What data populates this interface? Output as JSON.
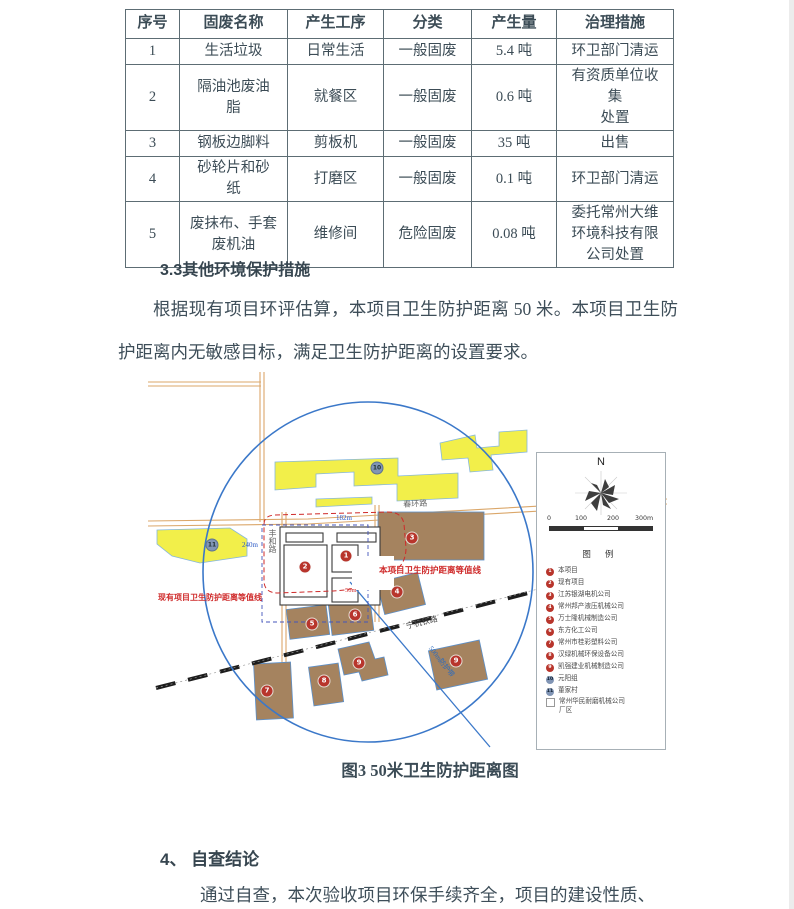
{
  "document": {
    "table": {
      "headers": [
        "序号",
        "固废名称",
        "产生工序",
        "分类",
        "产生量",
        "治理措施"
      ],
      "rows": [
        [
          "1",
          "生活垃圾",
          "日常生活",
          "一般固废",
          "5.4 吨",
          "环卫部门清运"
        ],
        [
          "2",
          "隔油池废油\n脂",
          "就餐区",
          "一般固废",
          "0.6 吨",
          "有资质单位收\n集\n处置"
        ],
        [
          "3",
          "钢板边脚料",
          "剪板机",
          "一般固废",
          "35 吨",
          "出售"
        ],
        [
          "4",
          "砂轮片和砂\n纸",
          "打磨区",
          "一般固废",
          "0.1 吨",
          "环卫部门清运"
        ],
        [
          "5",
          "废抹布、手套\n废机油",
          "维修间",
          "危险固废",
          "0.08 吨",
          "委托常州大维\n环境科技有限\n公司处置"
        ]
      ]
    },
    "section33": {
      "heading": "3.3其他环境保护措施",
      "paragraph": "根据现有项目环评估算，本项目卫生防护距离 50 米。本项目卫生防护距离内无敏感目标，满足卫生防护距离的设置要求。"
    },
    "figure": {
      "caption": "图3  50米卫生防护距离图",
      "map": {
        "north_label": "N",
        "scale_ticks": [
          "0",
          "100",
          "200",
          "300m"
        ],
        "legend_title": "图 例",
        "legend_items": [
          {
            "num": "1",
            "type": "red",
            "label": "本项目"
          },
          {
            "num": "2",
            "type": "red",
            "label": "现有项目"
          },
          {
            "num": "3",
            "type": "red",
            "label": "江苏银湖电机公司"
          },
          {
            "num": "4",
            "type": "red",
            "label": "常州邦产液压机械公司"
          },
          {
            "num": "5",
            "type": "red",
            "label": "万士隆机械制造公司"
          },
          {
            "num": "6",
            "type": "red",
            "label": "东方化工公司"
          },
          {
            "num": "7",
            "type": "red",
            "label": "常州市桂彩塑料公司"
          },
          {
            "num": "8",
            "type": "red",
            "label": "汉绿机械环保设备公司"
          },
          {
            "num": "9",
            "type": "red",
            "label": "凯强建业机械制造公司"
          },
          {
            "num": "10",
            "type": "blue",
            "label": "元阳组"
          },
          {
            "num": "11",
            "type": "blue",
            "label": "董家村"
          },
          {
            "num": "",
            "type": "square",
            "label": "常州华民耐磨机械公司\n厂区"
          }
        ],
        "road_labels": {
          "east_west": "春环路",
          "north_south": "丰和路",
          "railway": "宁杭铁路",
          "buffer": "500m防护带"
        },
        "contour_labels": {
          "project": "本项目卫生防护距离等值线",
          "existing": "现有项目卫生防护距离等值线"
        },
        "dim_labels": {
          "a": "182m",
          "b": "240m",
          "c": "50m"
        },
        "markers": [
          {
            "n": "10"
          },
          {
            "n": "11"
          },
          {
            "n": "1"
          },
          {
            "n": "2"
          },
          {
            "n": "3"
          },
          {
            "n": "4"
          },
          {
            "n": "5"
          },
          {
            "n": "6"
          },
          {
            "n": "7"
          },
          {
            "n": "8"
          },
          {
            "n": "9"
          },
          {
            "n": "9"
          }
        ],
        "colors": {
          "circle_blue": "#3b78c9",
          "parcel_yellow": "#f2ef4a",
          "building_brown": "#a5835f",
          "road_orange": "#dba76a",
          "marker_red": "#b8352c",
          "marker_blue": "#8195b5",
          "contour_red": "#cf2a2a"
        }
      }
    },
    "section4": {
      "heading": "4、 自查结论",
      "paragraph": "通过自查，本次验收项目环保手续齐全，项目的建设性质、"
    }
  }
}
